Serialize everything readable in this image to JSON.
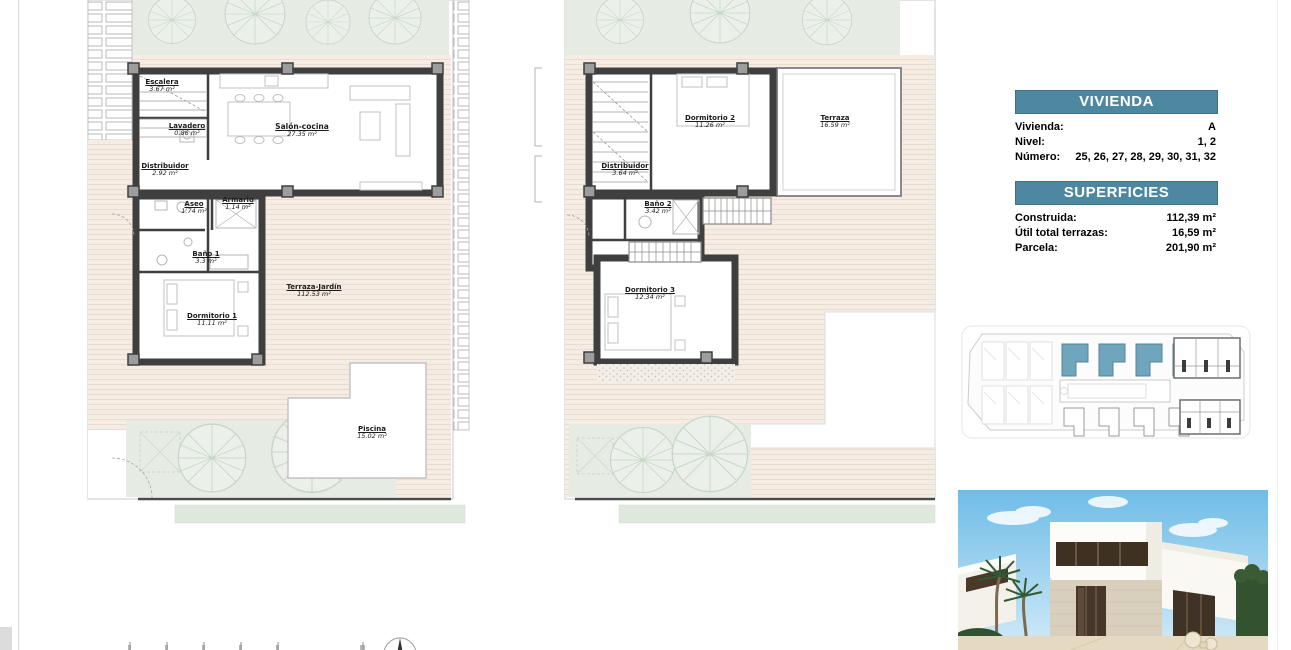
{
  "info": {
    "vivienda": {
      "title": "VIVIENDA",
      "rows": [
        {
          "label": "Vivienda:",
          "value": "A"
        },
        {
          "label": "Nivel:",
          "value": "1, 2"
        },
        {
          "label": "Número:",
          "value": "25, 26, 27, 28,  29, 30, 31, 32"
        }
      ]
    },
    "superficies": {
      "title": "SUPERFICIES",
      "rows": [
        {
          "label": "Construida:",
          "value": "112,39 m²"
        },
        {
          "label": "Útil total terrazas:",
          "value": "16,59 m²"
        },
        {
          "label": "Parcela:",
          "value": "201,90 m²"
        }
      ]
    }
  },
  "plans": {
    "ground": {
      "rooms": [
        {
          "name": "Escalera",
          "area": "3.67 m²"
        },
        {
          "name": "Lavadero",
          "area": "0.86 m²"
        },
        {
          "name": "Distribuidor",
          "area": "2.92 m²"
        },
        {
          "name": "Salón-cocina",
          "area": "27.35 m²"
        },
        {
          "name": "Aseo",
          "area": "1.74 m²"
        },
        {
          "name": "Armario",
          "area": "1.14 m²"
        },
        {
          "name": "Baño 1",
          "area": "3.3 m²"
        },
        {
          "name": "Dormitorio 1",
          "area": "11.11 m²"
        },
        {
          "name": "Terraza-Jardín",
          "area": "112.53 m²"
        },
        {
          "name": "Piscina",
          "area": "15.02 m²"
        }
      ]
    },
    "first": {
      "rooms": [
        {
          "name": "Dormitorio 2",
          "area": "11.26 m²"
        },
        {
          "name": "Terraza",
          "area": "16.59 m²"
        },
        {
          "name": "Distribuidor",
          "area": "3.64 m²"
        },
        {
          "name": "Baño 2",
          "area": "3.42 m²"
        },
        {
          "name": "Dormitorio 3",
          "area": "12.34 m²"
        }
      ]
    }
  },
  "colors": {
    "accent_teal": "#4e87a0",
    "site_highlight": "#70a5be",
    "wall_dark": "#3f3f3f",
    "garden_green": "#e6ece4",
    "terrace_beige": "#f5ece4"
  }
}
